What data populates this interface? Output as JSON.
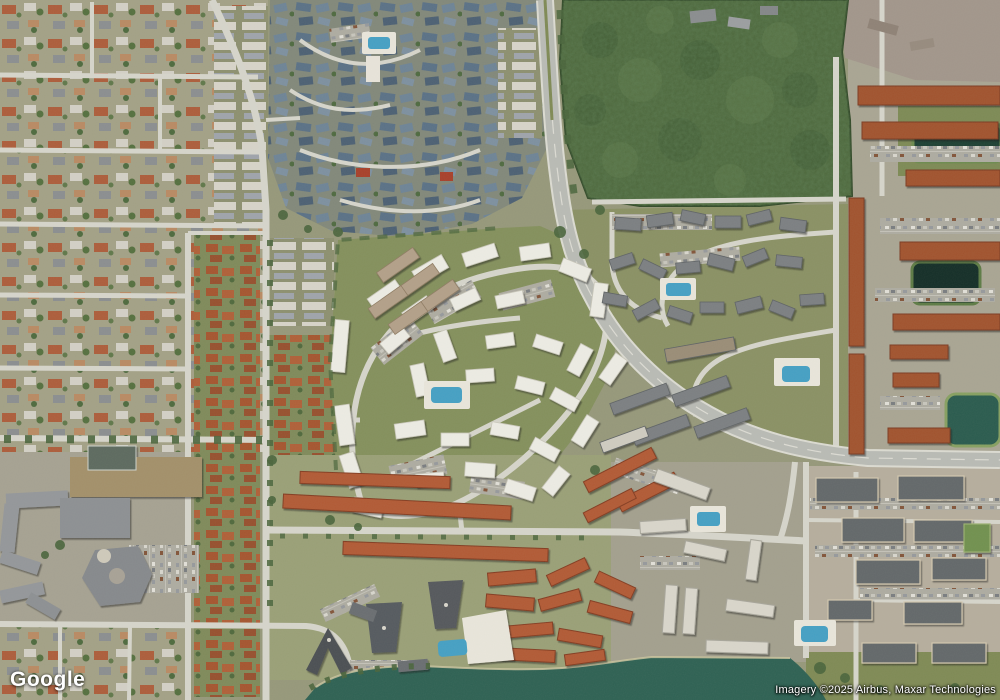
{
  "map": {
    "watermark_logo": "Google",
    "attribution": "Imagery ©2025 Airbus, Maxar Technologies"
  },
  "colors": {
    "ground": "#96987a",
    "forest": "#4b663a",
    "lake": "#2e6153",
    "pond": "#1d4033",
    "road_minor": "#d6d5cb",
    "road_major": "#b9bbb5",
    "roof_white": "#edece4",
    "roof_orange": "#a1522f",
    "roof_gray": "#7b7f82",
    "pool": "#45a0c4"
  }
}
